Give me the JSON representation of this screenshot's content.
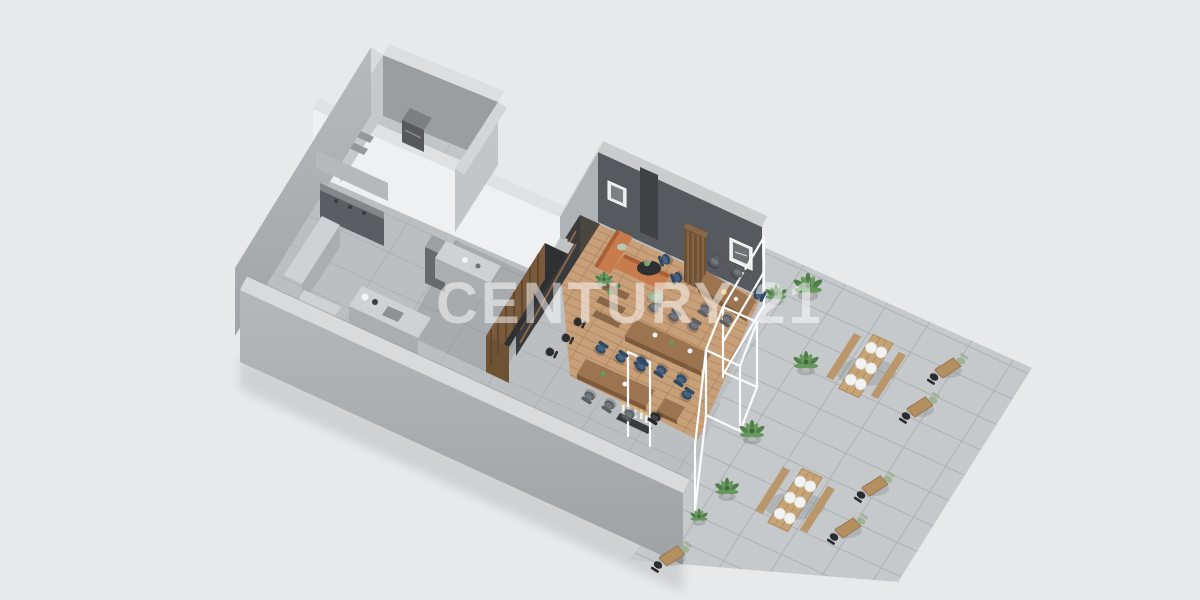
{
  "watermark": {
    "text": "CENTURY 21"
  },
  "colors": {
    "background": "#e8e9eb",
    "slabTop": "#d8dadc",
    "wallLight": "#c3c6c9",
    "wallShadow": "#9b9ea1",
    "whiteWall": "#eef0f2",
    "featureWall": "#56595d",
    "floorTile": "#bcbfc1",
    "grout": "#aeb1b4",
    "storageTile": "#c3c6c8",
    "paver": "#c6c9cb",
    "paverGrout": "#aeb1b3",
    "wood": "#c79f78",
    "woodLine": "#b0855c",
    "tableWood": "#9c7450",
    "barTop": "#2f3032",
    "barWood": "#7a5a3c",
    "backBar": "#3a3b3e",
    "steel": "#ced2d4",
    "steelFace": "#aaaeb1",
    "steelDark": "#5f6265",
    "sofa": "#c87b4c",
    "navyChair": "#2e4a6b",
    "grayChair": "#5d6166",
    "blackChair": "#26262a",
    "sageChair": "#9fb295",
    "plantGreen": "#4f7f4b",
    "picnicWood": "#c6a476",
    "glass": "#fafbfc"
  },
  "scene": {
    "type": "isometric-floorplan-render",
    "areas": [
      "storage-room",
      "commercial-kitchen",
      "bar-counter",
      "indoor-dining-lounge",
      "glazed-entry",
      "outdoor-terrace"
    ],
    "items": [
      {
        "t": "plant",
        "x": 808,
        "y": 290,
        "s": 1.15
      },
      {
        "t": "plant",
        "x": 806,
        "y": 366,
        "s": 1.0
      },
      {
        "t": "plant",
        "x": 752,
        "y": 435,
        "s": 1.0
      },
      {
        "t": "plant",
        "x": 727,
        "y": 492,
        "s": 0.95
      },
      {
        "t": "plant",
        "x": 699,
        "y": 519,
        "s": 0.7
      },
      {
        "t": "plant",
        "x": 776,
        "y": 297,
        "s": 0.85
      },
      {
        "t": "plant",
        "x": 604,
        "y": 282,
        "s": 0.7
      },
      {
        "t": "picnic",
        "x": 866,
        "y": 366
      },
      {
        "t": "picnic",
        "x": 795,
        "y": 500
      },
      {
        "t": "cafe",
        "x": 948,
        "y": 368
      },
      {
        "t": "cafe",
        "x": 920,
        "y": 407
      },
      {
        "t": "cafe",
        "x": 875,
        "y": 486
      },
      {
        "t": "cafe",
        "x": 848,
        "y": 528
      },
      {
        "t": "cafe",
        "x": 672,
        "y": 556
      },
      {
        "t": "stool",
        "x": 550,
        "y": 352,
        "a": 115
      },
      {
        "t": "stool",
        "x": 566,
        "y": 338,
        "a": 115
      },
      {
        "t": "stool",
        "x": 578,
        "y": 322,
        "a": 115
      },
      {
        "t": "chair",
        "x": 642,
        "y": 360,
        "a": 213,
        "c": "#2e4a6b"
      },
      {
        "t": "chair",
        "x": 662,
        "y": 369,
        "a": 213,
        "c": "#2e4a6b"
      },
      {
        "t": "chair",
        "x": 682,
        "y": 378,
        "a": 213,
        "c": "#2e4a6b"
      },
      {
        "t": "chair",
        "x": 600,
        "y": 350,
        "a": 33,
        "c": "#2e4a6b"
      },
      {
        "t": "chair",
        "x": 620,
        "y": 359,
        "a": 33,
        "c": "#2e4a6b"
      },
      {
        "t": "chair",
        "x": 640,
        "y": 368,
        "a": 33,
        "c": "#2e4a6b"
      },
      {
        "t": "chair",
        "x": 757,
        "y": 294,
        "a": 115,
        "c": "#2e4a6b"
      },
      {
        "t": "chair",
        "x": 686,
        "y": 396,
        "a": 33,
        "c": "#2e4a6b"
      },
      {
        "t": "chair",
        "x": 667,
        "y": 259,
        "a": 250,
        "c": "#2e4a6b"
      },
      {
        "t": "chair",
        "x": 679,
        "y": 277,
        "a": 250,
        "c": "#2e4a6b"
      },
      {
        "t": "chair",
        "x": 653,
        "y": 309,
        "a": 33,
        "c": "#5d6166"
      },
      {
        "t": "chair",
        "x": 673,
        "y": 318,
        "a": 33,
        "c": "#5d6166"
      },
      {
        "t": "chair",
        "x": 693,
        "y": 327,
        "a": 33,
        "c": "#5d6166"
      },
      {
        "t": "chair",
        "x": 590,
        "y": 395,
        "a": 213,
        "c": "#5d6166"
      },
      {
        "t": "chair",
        "x": 610,
        "y": 404,
        "a": 213,
        "c": "#5d6166"
      },
      {
        "t": "chair",
        "x": 630,
        "y": 413,
        "a": 213,
        "c": "#5d6166"
      },
      {
        "t": "chair",
        "x": 714,
        "y": 263,
        "a": 33,
        "c": "#5d6166"
      },
      {
        "t": "chair",
        "x": 737,
        "y": 274,
        "a": 33,
        "c": "#5d6166"
      },
      {
        "t": "chair",
        "x": 706,
        "y": 308,
        "a": 213,
        "c": "#5d6166"
      },
      {
        "t": "chair",
        "x": 728,
        "y": 318,
        "a": 213,
        "c": "#5d6166"
      },
      {
        "t": "chair",
        "x": 656,
        "y": 416,
        "a": 213,
        "c": "#26262a"
      },
      {
        "t": "pouf",
        "x": 656,
        "y": 297
      }
    ]
  }
}
